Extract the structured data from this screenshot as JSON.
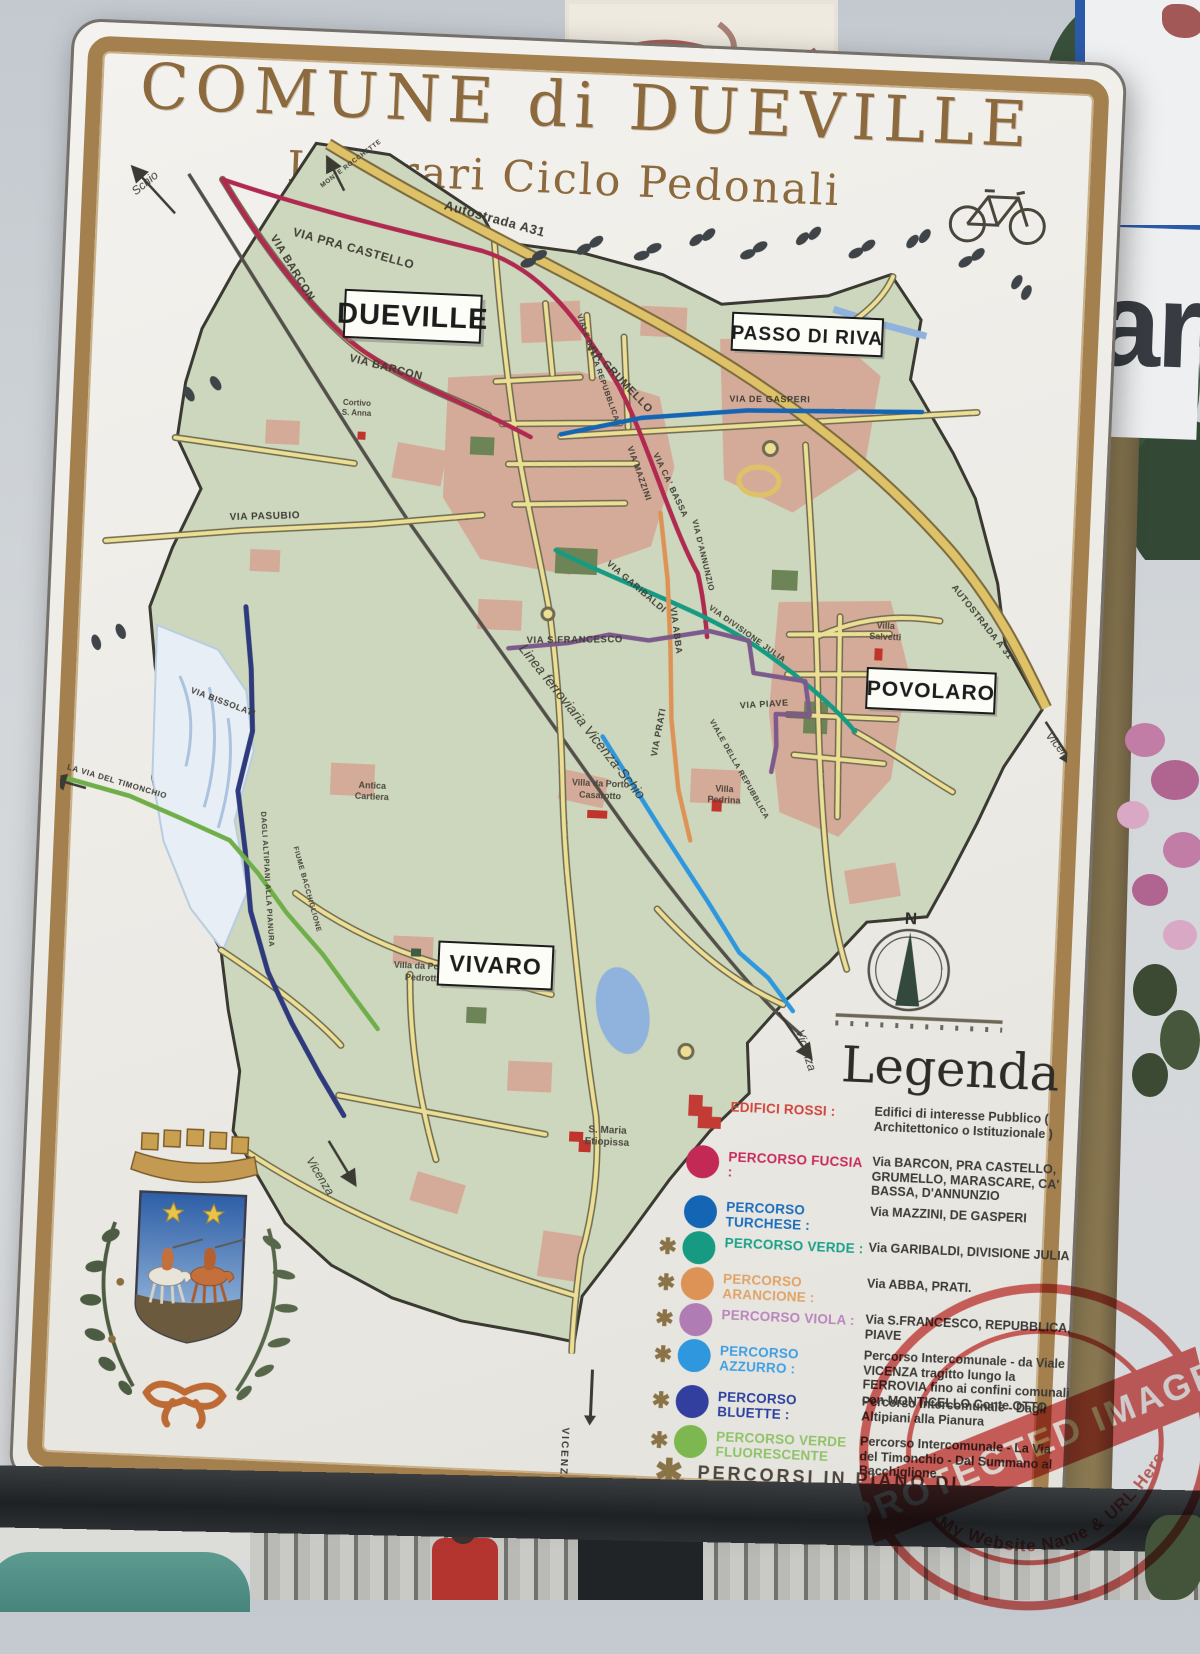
{
  "scene": {
    "adjacent_sign_text": "ar"
  },
  "sign": {
    "title": "COMUNE di DUEVILLE",
    "subtitle": "Itinerari Ciclo Pedonali",
    "map": {
      "towns": {
        "dueville": "DUEVILLE",
        "passo_di_riva": "PASSO DI RIVA",
        "povolaro": "POVOLARO",
        "vivaro": "VIVARO"
      },
      "roads": {
        "pra_castello": "VIA  PRA CASTELLO",
        "autostrada": "Autostrada A31",
        "autostrada_along": "AUTOSTRADA  A 31",
        "grumello": "VIA GRUMELLO",
        "barcon_nw": "VIA BARCON",
        "barcon_s": "VIA  BARCON",
        "pasubio": "VIA PASUBIO",
        "de_gasperi": "VIA DE GASPERI",
        "mazzini": "VIA MAZZINI",
        "ca_bassa": "VIA CA' BASSA",
        "d_annunzio": "VIA D'ANNUNZIO",
        "repubblica_n": "VIALE DELLA REPUBBLICA",
        "garibaldi": "VIA GARIBALDI",
        "abba": "VIA ABBA",
        "divisione_julia": "VIA DIVISIONE JULIA",
        "s_francesco": "VIA S.FRANCESCO",
        "prati": "VIA PRATI",
        "piave": "VIA  PIAVE",
        "repubblica_s": "VIALE DELLA REPUBBLICA",
        "bissolati": "VIA BISSOLATI",
        "ferrovia": "Linea ferroviaria Vicenza-Schio"
      },
      "places": {
        "cortivo_1": "Cortivo",
        "cortivo_2": "S. Anna",
        "salvetti_1": "Villa",
        "salvetti_2": "Salvetti",
        "casarotto_1": "Villa da Porto",
        "casarotto_2": "Casarotto",
        "pedrina_1": "Villa",
        "pedrina_2": "Pedrina",
        "pedrotti_1": "Villa da Porto",
        "pedrotti_2": "Pedrotti",
        "cartiera_1": "Antica",
        "cartiera_2": "Cartiera",
        "etiopissa_1": "S. Maria",
        "etiopissa_2": "Etiopissa"
      },
      "edges": {
        "schio": "Schio",
        "monte_rocchette": "MONTE ROCCHETTE",
        "vicenza_e": "Vicenza",
        "vicenza_se": "Vicenza",
        "vicenza_sw": "Vicenza",
        "vicenza_s": "VICENZA",
        "timonchio": "LA VIA DEL TIMONCHIO",
        "altipiani": "DAGLI ALTIPIANI ALLA PIANURA",
        "bacchiglione": "FIUME BACCHIGLIONE"
      },
      "compass_label": "N",
      "route_colors": {
        "fucsia": "#b02a50",
        "turchese": "#1565b5",
        "verde": "#169b82",
        "arancione": "#de9356",
        "viola": "#7d5a8c",
        "azzurro": "#2e97dd",
        "bluette": "#2e3a7c",
        "verdefluo": "#6fae49",
        "autostrada": "#dfc268",
        "road": "#ecdf94",
        "railway": "#53504a"
      }
    },
    "legend": {
      "heading": "Legenda",
      "items": [
        {
          "type": "building",
          "asterisk": false,
          "color": "#c23b34",
          "name_color": "#d0453c",
          "name": "EDIFICI ROSSI :",
          "desc": "Edifici di interesse Pubblico ( Architettonico o Istituzionale )"
        },
        {
          "type": "route",
          "asterisk": false,
          "color": "#c22a55",
          "name_color": "#c92a5e",
          "name": "PERCORSO FUCSIA :",
          "desc": "Via BARCON, PRA CASTELLO, GRUMELLO, MARASCARE, CA' BASSA, D'ANNUNZIO"
        },
        {
          "type": "route",
          "asterisk": false,
          "color": "#1565b5",
          "name_color": "#1a6dbd",
          "name": "PERCORSO TURCHESE :",
          "desc": "Via MAZZINI, DE GASPERI"
        },
        {
          "type": "route",
          "asterisk": true,
          "color": "#169b82",
          "name_color": "#18a289",
          "name": "PERCORSO VERDE :",
          "desc": "Via GARIBALDI, DIVISIONE JULIA"
        },
        {
          "type": "route",
          "asterisk": true,
          "color": "#de9356",
          "name_color": "#e0a368",
          "name": "PERCORSO ARANCIONE :",
          "desc": "Via  ABBA, PRATI."
        },
        {
          "type": "route",
          "asterisk": true,
          "color": "#b07cb4",
          "name_color": "#b985bd",
          "name": "PERCORSO VIOLA :",
          "desc": "Via S.FRANCESCO, REPUBBLICA, PIAVE"
        },
        {
          "type": "route",
          "asterisk": true,
          "color": "#2e97dd",
          "name_color": "#3da0e3",
          "name": "PERCORSO AZZURRO :",
          "desc": "Percorso Intercomunale - da Viale VICENZA tragitto lungo la FERROVIA fino ai confini comunali con MONTICELLO Conte OTTO"
        },
        {
          "type": "route",
          "asterisk": true,
          "color": "#333f9e",
          "name_color": "#2b3f9f",
          "name": "PERCORSO BLUETTE :",
          "desc": "Percorso Intercomunale - Dagli Altipiani alla Pianura"
        },
        {
          "type": "route",
          "asterisk": true,
          "color": "#7cb84f",
          "name_color": "#8fc368",
          "name": "PERCORSO VERDE FLUORESCENTE",
          "desc": "Percorso Intercomunale - La Via del Timonchio - Dal Summano al Bacchiglione"
        }
      ],
      "footer": "PERCORSI IN PIANO DI ATTUAZIONE"
    }
  },
  "watermark": {
    "line1": "PROTECTED IMAGE",
    "line2": "My Website Name & URL Here"
  }
}
